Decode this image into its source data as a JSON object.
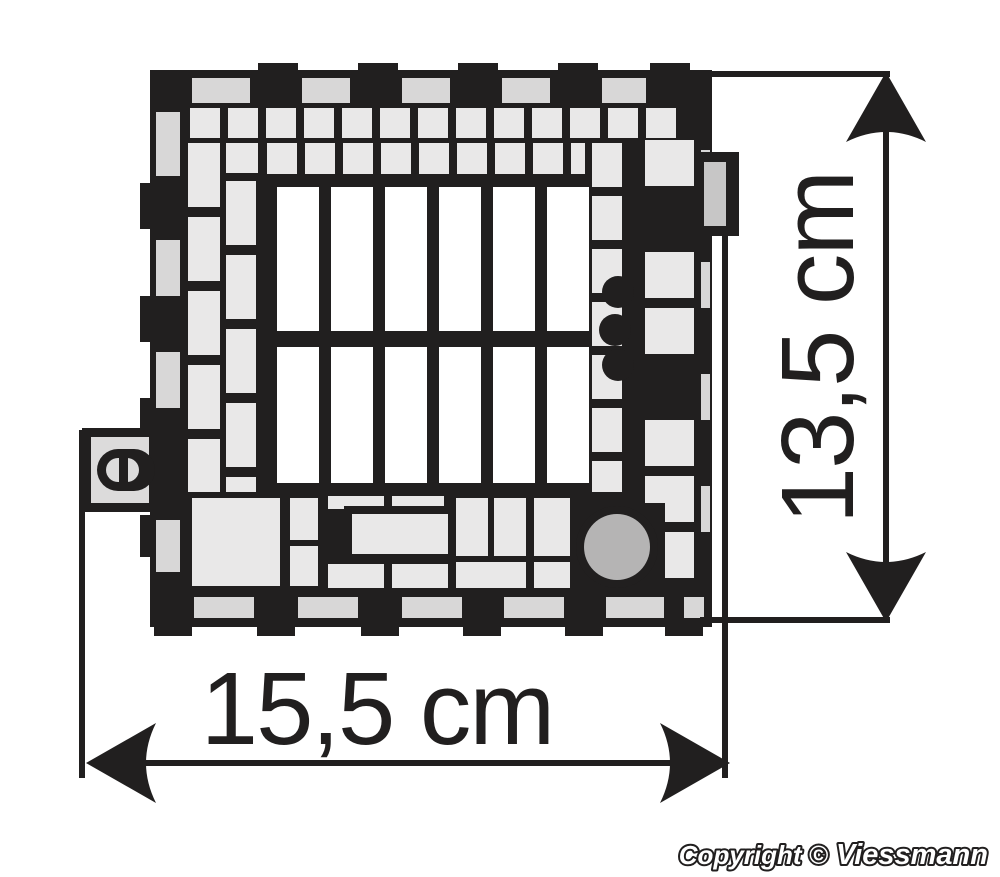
{
  "diagram": {
    "kind": "product dimension drawing",
    "subject": "model wall with gate, top view with brick pattern, gate bars, hinge pins, barrel and latch details",
    "dimensions": {
      "width_label": "15,5 cm",
      "width_value_cm": 15.5,
      "height_label": "13,5 cm",
      "height_value_cm": 13.5,
      "unit": "cm"
    },
    "copyright": {
      "prefix": "Copyright ©",
      "brand": "Viessmann"
    },
    "colors": {
      "ink": "#211f1f",
      "brick": "#e9e8e8",
      "brick2": "#d8d7d7",
      "mid": "#c7c6c6",
      "mid2": "#dcdbdb",
      "circle": "#b5b4b4",
      "background": "#ffffff"
    }
  }
}
